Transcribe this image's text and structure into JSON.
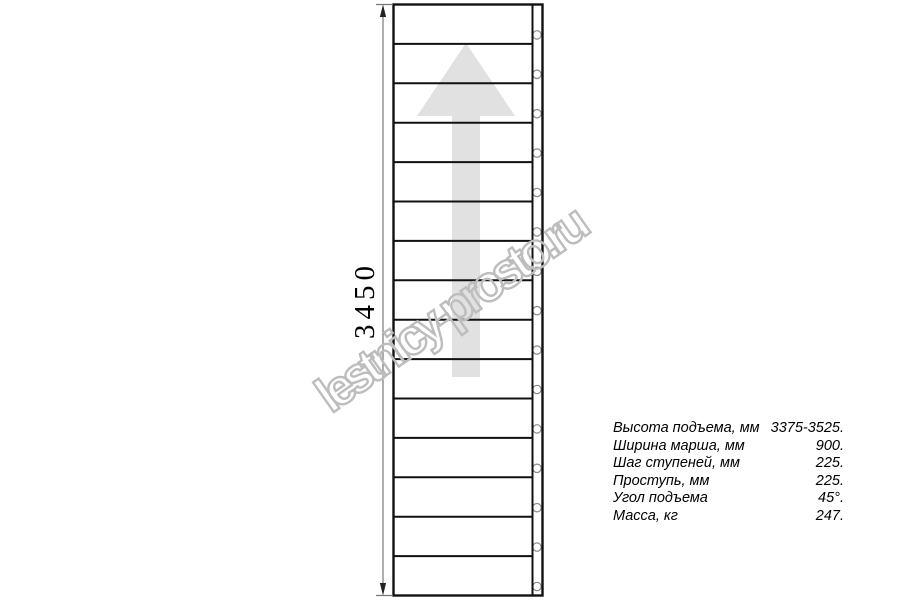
{
  "drawing": {
    "dimension_label": "3450",
    "steps_count": 15,
    "geometry": {
      "left": 393.5,
      "top": 4.5,
      "right": 542.5,
      "bottom": 595.5,
      "stringer_x": 532.5,
      "bolt_cx": 537,
      "bolt_r": 4.2,
      "bolt_offset": 9,
      "dim_x": 383
    },
    "colors": {
      "line": "#111111",
      "arrow": "#e1e1e1",
      "bolt_stroke": "#8a8a8a",
      "dimension": "#777777",
      "dimension_arrow": "#222222",
      "text": "#000000"
    }
  },
  "watermark": {
    "text": "lestnicy-prosto.ru",
    "color": "#bdbdbd"
  },
  "specs": {
    "rows": [
      {
        "label": "Высота подъема, мм",
        "value": "3375-3525."
      },
      {
        "label": "Ширина марша, мм",
        "value": "900."
      },
      {
        "label": "Шаг ступеней, мм",
        "value": "225."
      },
      {
        "label": "Проступь, мм",
        "value": "225."
      },
      {
        "label": "Угол подъема",
        "value": "45°."
      },
      {
        "label": "Масса, кг",
        "value": "247."
      }
    ]
  }
}
